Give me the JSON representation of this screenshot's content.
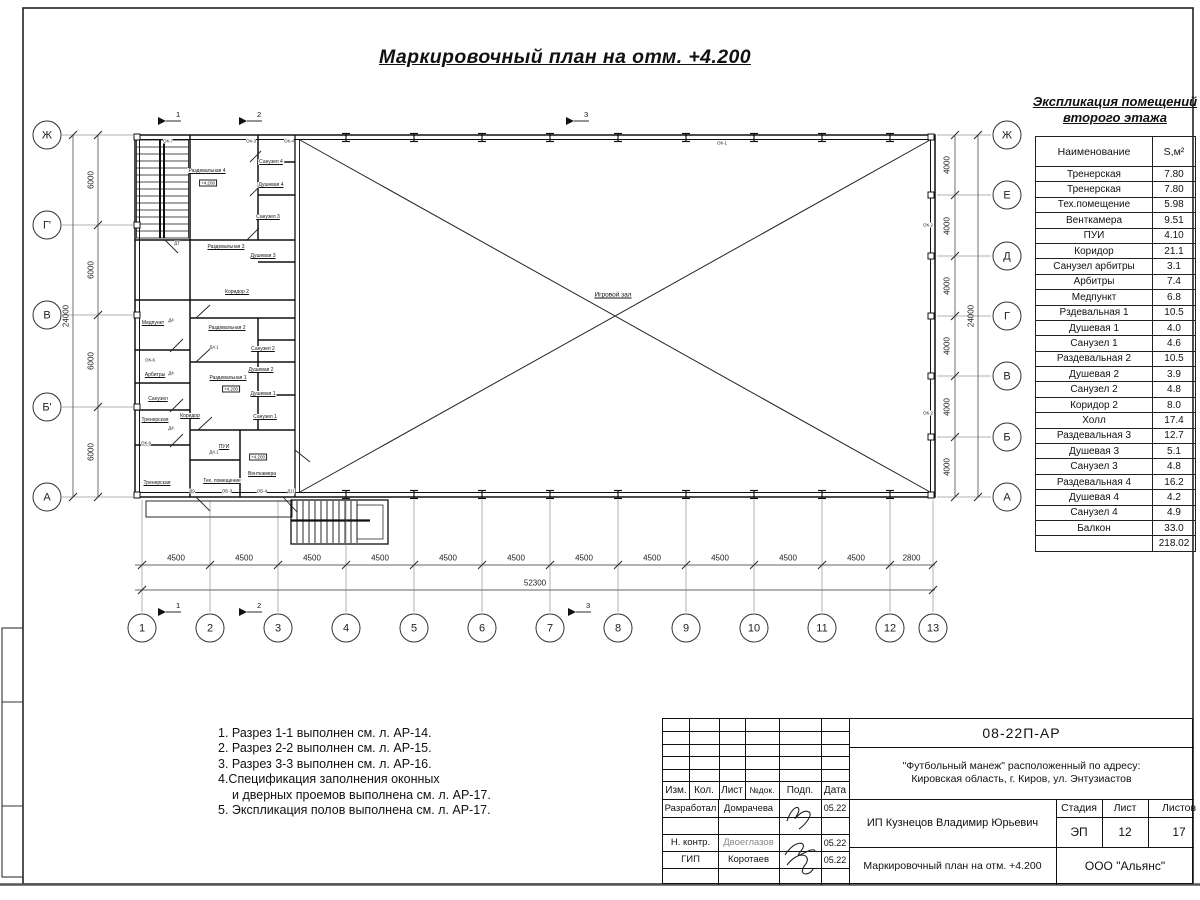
{
  "sheet": {
    "title": "Маркировочный план на отм. +4.200"
  },
  "plan": {
    "hall_label": "Игровой зал",
    "axes_bottom": [
      "1",
      "2",
      "3",
      "4",
      "5",
      "6",
      "7",
      "8",
      "9",
      "10",
      "11",
      "12",
      "13"
    ],
    "axes_left": [
      "Ж",
      "Г'",
      "В",
      "Б'",
      "А"
    ],
    "axes_right": [
      "Ж",
      "Е",
      "Д",
      "Г",
      "В",
      "Б",
      "А"
    ],
    "dims_bottom": [
      "4500",
      "4500",
      "4500",
      "4500",
      "4500",
      "4500",
      "4500",
      "4500",
      "4500",
      "4500",
      "4500",
      "2800"
    ],
    "dims_bottom_total": "52300",
    "dims_left": [
      "6000",
      "6000",
      "6000",
      "6000"
    ],
    "dims_left_total": "24000",
    "dims_right": [
      "4000",
      "4000",
      "4000",
      "4000",
      "4000",
      "4000"
    ],
    "dims_right_total": "24000",
    "section_marks": [
      "1",
      "2",
      "3"
    ],
    "level_mark": "+4.200",
    "rooms": [
      {
        "t": "Раздевальная 4",
        "x": 207,
        "y": 171
      },
      {
        "t": "Санузел 4",
        "x": 271,
        "y": 162
      },
      {
        "t": "Душевая 4",
        "x": 271,
        "y": 185
      },
      {
        "t": "Санузел 3",
        "x": 268,
        "y": 217
      },
      {
        "t": "Душевая 3",
        "x": 263,
        "y": 256
      },
      {
        "t": "Раздевальная 3",
        "x": 226,
        "y": 247
      },
      {
        "t": "Коридор 2",
        "x": 237,
        "y": 292
      },
      {
        "t": "Раздевальная 2",
        "x": 227,
        "y": 328
      },
      {
        "t": "Санузел 2",
        "x": 263,
        "y": 349
      },
      {
        "t": "Душевая 2",
        "x": 261,
        "y": 370
      },
      {
        "t": "Раздевальная 1",
        "x": 228,
        "y": 378
      },
      {
        "t": "Душевая 1",
        "x": 263,
        "y": 394
      },
      {
        "t": "Санузел 1",
        "x": 265,
        "y": 417
      },
      {
        "t": "Коридор",
        "x": 190,
        "y": 416
      },
      {
        "t": "Медпункт",
        "x": 153,
        "y": 323
      },
      {
        "t": "Арбитры",
        "x": 155,
        "y": 375
      },
      {
        "t": "Санузел",
        "x": 158,
        "y": 399
      },
      {
        "t": "Тренерская",
        "x": 155,
        "y": 420
      },
      {
        "t": "Тренерская",
        "x": 157,
        "y": 483
      },
      {
        "t": "ПУИ",
        "x": 224,
        "y": 447
      },
      {
        "t": "Тех. помещение",
        "x": 222,
        "y": 481
      },
      {
        "t": "Венткамера",
        "x": 262,
        "y": 474
      }
    ],
    "tags": [
      {
        "t": "ОК-7",
        "x": 168,
        "y": 141
      },
      {
        "t": "ОК-3",
        "x": 251,
        "y": 141
      },
      {
        "t": "ОК-4",
        "x": 289,
        "y": 141
      },
      {
        "t": "ОК-1",
        "x": 722,
        "y": 143
      },
      {
        "t": "ОК-2",
        "x": 928,
        "y": 225
      },
      {
        "t": "ОК-2",
        "x": 928,
        "y": 413
      },
      {
        "t": "ОК-6",
        "x": 150,
        "y": 360
      },
      {
        "t": "ОК-9",
        "x": 146,
        "y": 443
      },
      {
        "t": "ДТ",
        "x": 177,
        "y": 243
      },
      {
        "t": "Д4",
        "x": 171,
        "y": 320
      },
      {
        "t": "Д4.1",
        "x": 214,
        "y": 347
      },
      {
        "t": "Д4",
        "x": 171,
        "y": 373
      },
      {
        "t": "Д4",
        "x": 171,
        "y": 428
      },
      {
        "t": "Д4.1",
        "x": 214,
        "y": 452
      },
      {
        "t": "Д9",
        "x": 192,
        "y": 491
      },
      {
        "t": "ОБ-3",
        "x": 227,
        "y": 491
      },
      {
        "t": "ОБ-4",
        "x": 262,
        "y": 491
      },
      {
        "t": "Д11",
        "x": 291,
        "y": 491
      }
    ],
    "levels": [
      {
        "x": 208,
        "y": 183
      },
      {
        "x": 231,
        "y": 389
      },
      {
        "x": 258,
        "y": 457
      }
    ]
  },
  "schedule": {
    "title_line1": "Экспликация помещений",
    "title_line2": "второго этажа",
    "col_name": "Наименование",
    "col_area": "S,м²",
    "rows": [
      [
        "Тренерская",
        "7.80"
      ],
      [
        "Тренерская",
        "7.80"
      ],
      [
        "Тех.помещение",
        "5.98"
      ],
      [
        "Венткамера",
        "9.51"
      ],
      [
        "ПУИ",
        "4.10"
      ],
      [
        "Коридор",
        "21.1"
      ],
      [
        "Санузел арбитры",
        "3.1"
      ],
      [
        "Арбитры",
        "7.4"
      ],
      [
        "Медпункт",
        "6.8"
      ],
      [
        "Рздевальная 1",
        "10.5"
      ],
      [
        "Душевая 1",
        "4.0"
      ],
      [
        "Санузел 1",
        "4.6"
      ],
      [
        "Раздевальная 2",
        "10.5"
      ],
      [
        "Душевая 2",
        "3.9"
      ],
      [
        "Санузел 2",
        "4.8"
      ],
      [
        "Коридор 2",
        "8.0"
      ],
      [
        "Холл",
        "17.4"
      ],
      [
        "Раздевальная 3",
        "12.7"
      ],
      [
        "Душевая 3",
        "5.1"
      ],
      [
        "Санузел 3",
        "4.8"
      ],
      [
        "Раздевальная 4",
        "16.2"
      ],
      [
        "Душевая 4",
        "4.2"
      ],
      [
        "Санузел 4",
        "4.9"
      ],
      [
        "Балкон",
        "33.0"
      ]
    ],
    "total": "218.02"
  },
  "notes": [
    "1. Разрез 1-1 выполнен см. л. АР-14.",
    "2. Разрез 2-2 выполнен см. л. АР-15.",
    "3. Разрез 3-3 выполнен см. л. АР-16.",
    "4.Спецификация заполнения оконных",
    "и дверных проемов выполнена см. л. АР-17.",
    "5. Экспликация полов выполнена см. л. АР-17."
  ],
  "titleblock": {
    "doc_number": "08-22П-АР",
    "address_line1": "\"Футбольный манеж\" расположенный по адресу:",
    "address_line2": "Кировская область, г. Киров, ул. Энтузиастов",
    "header_cols": [
      "Изм.",
      "Кол.",
      "Лист",
      "№док.",
      "Подп.",
      "Дата"
    ],
    "rows": [
      {
        "role": "Разработал",
        "name": "Домрачева",
        "date": "05.22"
      },
      {
        "role": "",
        "name": "",
        "date": ""
      },
      {
        "role": "Н. контр.",
        "name": "Двоеглазов",
        "date": "05.22"
      },
      {
        "role": "ГИП",
        "name": "Коротаев",
        "date": "05.22"
      }
    ],
    "client": "ИП Кузнецов Владимир Юрьевич",
    "stage_label": "Стадия",
    "sheet_label": "Лист",
    "sheets_label": "Листов",
    "stage": "ЭП",
    "sheet_no": "12",
    "sheets_total": "17",
    "drawing_title": "Маркировочный план на отм. +4.200",
    "company": "ООО \"Альянс\""
  }
}
